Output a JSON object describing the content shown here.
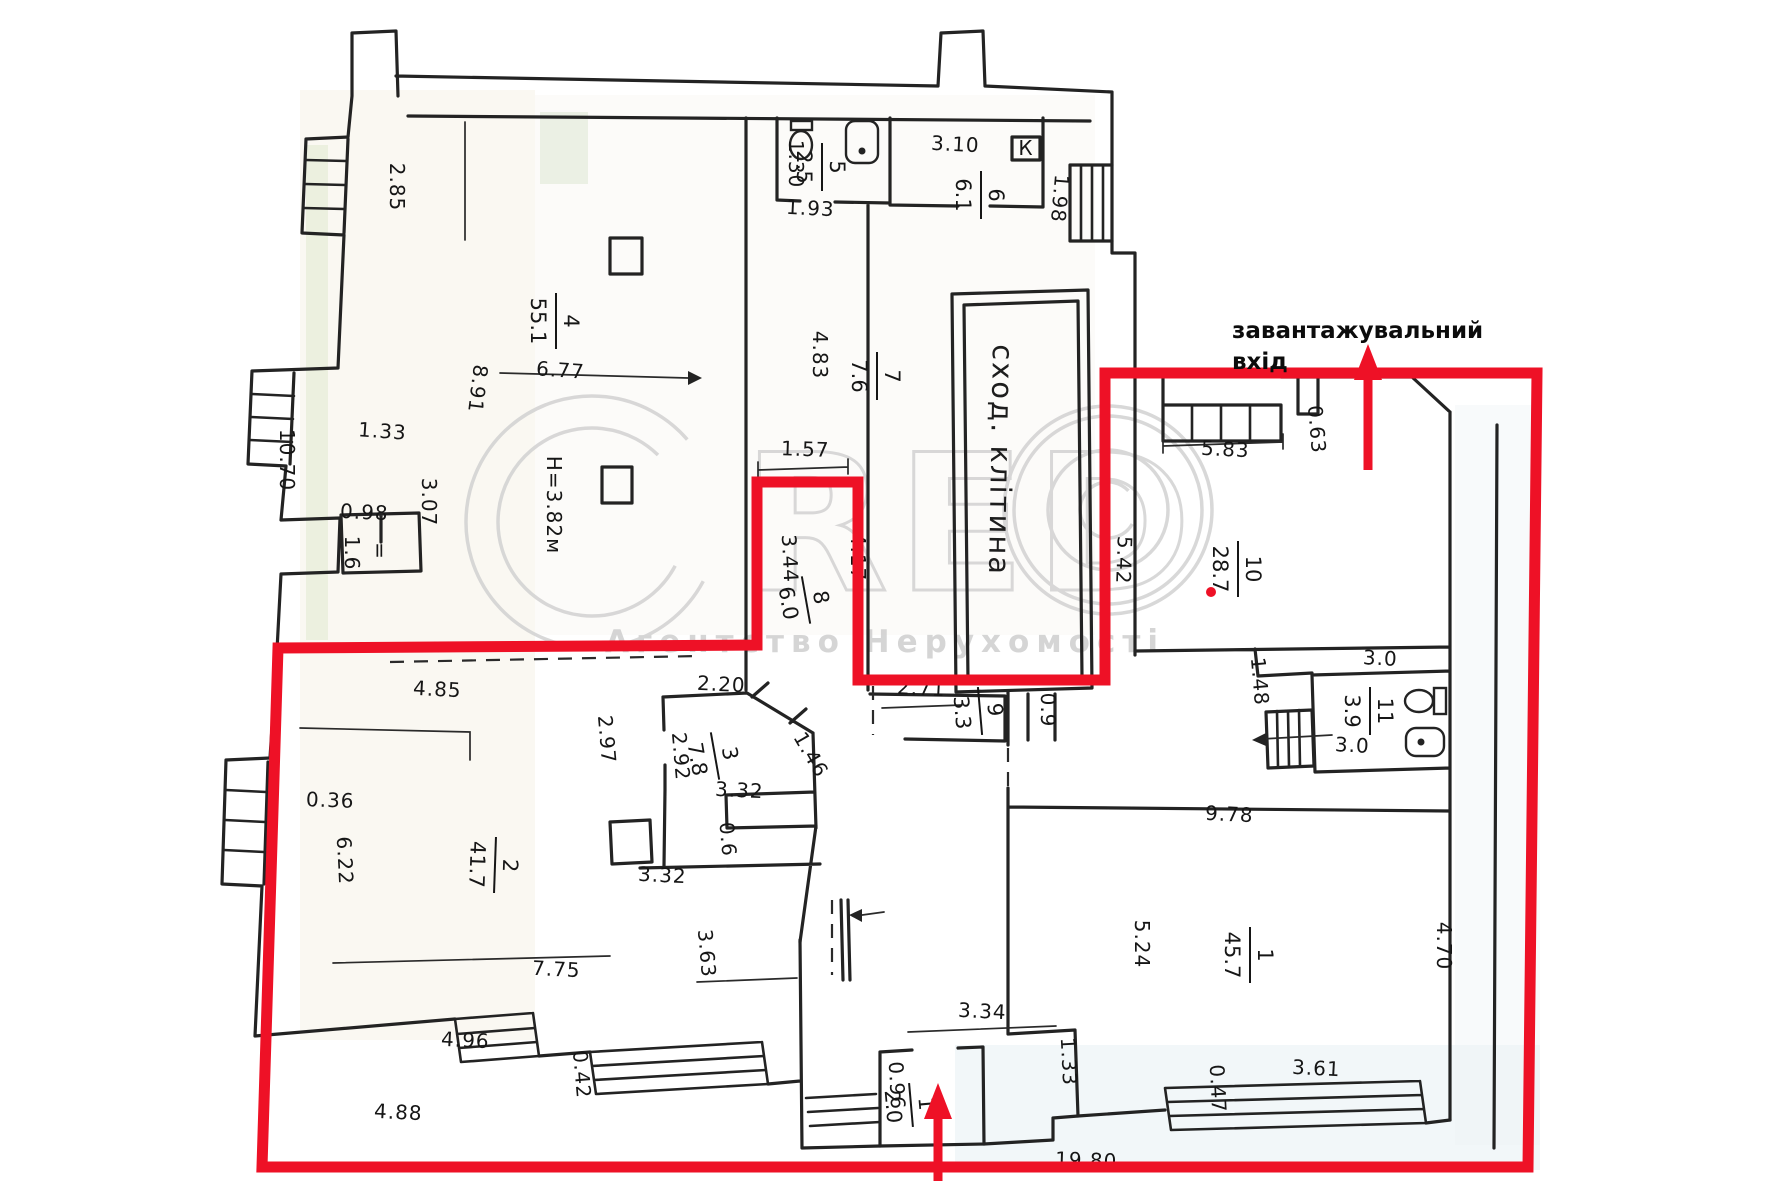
{
  "document": {
    "type": "floor-plan-scan",
    "height_note": "Н=3.82м",
    "stairwell_label": "сход. клітина",
    "annotation": {
      "line1": "завантажувальний",
      "line2": "вхід"
    }
  },
  "colors": {
    "highlight_red": "#ee1126",
    "wall_black": "#232323",
    "watermark_gray": "#cfcfcf",
    "paper_beige": "#f3efe2",
    "paper_blue": "#e8f0f4"
  },
  "watermark": {
    "brand_first_letter": "C",
    "brand_rest": "RED",
    "agency": "Агентство Нерухомості"
  },
  "labels": [
    "2.85",
    "8.91",
    "10.70",
    "1.33",
    "3.07",
    "0.98",
    "1.6",
    "=",
    "Н=3.82м",
    "6.77",
    "1.30",
    "1.93",
    "3.10",
    "1.98",
    "4.83",
    "1.57",
    "3.44",
    "4.17",
    "2.71",
    "0.9",
    "5.42",
    "5.83",
    "0.63",
    "1.48",
    "3.0",
    "3.0",
    "9.78",
    "5.24",
    "4.70",
    "1.33",
    "3.34",
    "0.47",
    "3.61",
    "0.96",
    "4.85",
    "0.36",
    "6.22",
    "2.97",
    "2.92",
    "2.20",
    "3.32",
    "1.46",
    "0.6",
    "3.32",
    "7.75",
    "3.63",
    "4.96",
    "0.42",
    "4.88",
    "19.80",
    "К"
  ],
  "rooms": [
    {
      "num": "4",
      "area": "55.1"
    },
    {
      "num": "5",
      "area": "2.5"
    },
    {
      "num": "6",
      "area": "6.1"
    },
    {
      "num": "7",
      "area": "7.6"
    },
    {
      "num": "8",
      "area": "6.0"
    },
    {
      "num": "9",
      "area": "3.3"
    },
    {
      "num": "10",
      "area": "28.7"
    },
    {
      "num": "11",
      "area": "3.9"
    },
    {
      "num": "1",
      "area": "45.7"
    },
    {
      "num": "1",
      "area": "2.0"
    },
    {
      "num": "2",
      "area": "41.7"
    },
    {
      "num": "3",
      "area": "7.8"
    }
  ]
}
